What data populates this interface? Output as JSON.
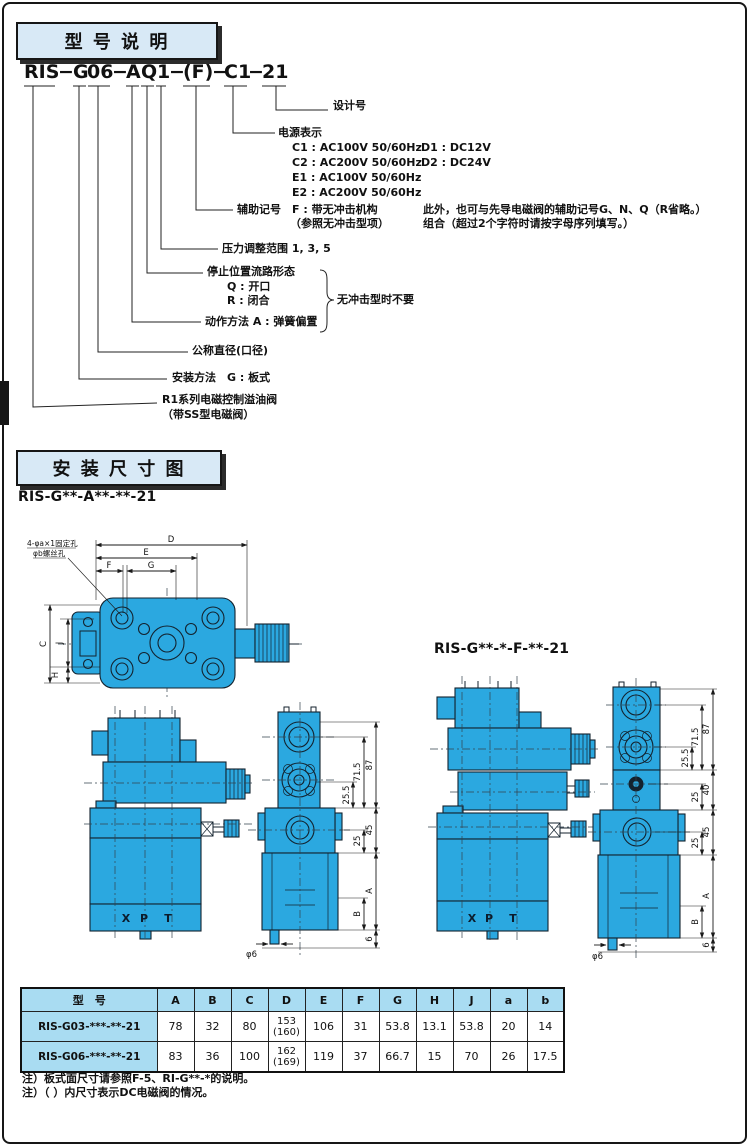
{
  "colors": {
    "cyan": "#2BA8E0",
    "panel": "#D8E9F6",
    "table_header": "#A9DCF2",
    "ink": "#111111"
  },
  "section1": {
    "title": "型 号 说 明",
    "code": [
      "RIS",
      "−",
      "G",
      "06",
      "−",
      "A",
      "Q",
      "1",
      "−",
      "(F)",
      "−",
      "C1",
      "−",
      "21"
    ],
    "callouts": {
      "design": "设计号",
      "power_title": "电源表示",
      "power_options": [
        {
          "left": "C1 : AC100V 50/60Hz",
          "right": "D1 : DC12V"
        },
        {
          "left": "C2 : AC200V 50/60Hz",
          "right": "D2 : DC24V"
        },
        {
          "left": "E1 : AC100V 50/60Hz",
          "right": ""
        },
        {
          "left": "E2 : AC200V 50/60Hz",
          "right": ""
        }
      ],
      "aux_line1": "辅助记号　F : 带无冲击机构",
      "aux_line2": "（参照无冲击型项）",
      "aux_note1": "此外，也可与先导电磁阀的辅助记号G、N、Q（R省略。）",
      "aux_note2": "组合（超过2个字符时请按字母序列填写。）",
      "pressure": "压力调整范围 1, 3, 5",
      "stop_title": "停止位置流路形态",
      "stop_q": "Q : 开口",
      "stop_r": "R : 闭合",
      "brace_note": "无冲击型时不要",
      "action": "动作方法 A : 弹簧偏置",
      "diameter": "公称直径(口径)",
      "mounting": "安装方法　G : 板式",
      "series1": "R1系列电磁控制溢油阀",
      "series2": "（带SS型电磁阀）"
    }
  },
  "section2": {
    "title": "安 装 尺 寸 图",
    "variant_a": "RIS-G**-A**-**-21",
    "variant_f": "RIS-G**-*-F-**-21",
    "hole_note1": "4-φa×1固定孔",
    "hole_note2": "φb螺丝孔",
    "dims": {
      "top": {
        "D": "D",
        "E": "E",
        "F": "F",
        "G": "G",
        "C": "C",
        "J": "J",
        "H": "H"
      },
      "front_a": {
        "h87": "87",
        "h715": "71.5",
        "h255": "25.5",
        "h45": "45",
        "h25": "25",
        "hA": "A",
        "hB": "B",
        "h6": "6",
        "phi": "φ6"
      },
      "front_f": {
        "h87": "87",
        "h715": "71.5",
        "h255": "25.5",
        "h40": "40",
        "h25a": "25",
        "h45": "45",
        "h25b": "25",
        "hA": "A",
        "hB": "B",
        "h6": "6",
        "phi": "φ6"
      },
      "ports": {
        "x": "X",
        "p": "P",
        "t": "T"
      }
    }
  },
  "table": {
    "headers": [
      "型　号",
      "A",
      "B",
      "C",
      "D",
      "E",
      "F",
      "G",
      "H",
      "J",
      "a",
      "b"
    ],
    "rows": [
      {
        "model": "RIS-G03-***-**-21",
        "A": "78",
        "B": "32",
        "C": "80",
        "D1": "153",
        "D2": "(160)",
        "E": "106",
        "F": "31",
        "G": "53.8",
        "H": "13.1",
        "J": "53.8",
        "a2": "20",
        "b2": "14"
      },
      {
        "model": "RIS-G06-***-**-21",
        "A": "83",
        "B": "36",
        "C": "100",
        "D1": "162",
        "D2": "(169)",
        "E": "119",
        "F": "37",
        "G": "66.7",
        "H": "15",
        "J": "70",
        "a2": "26",
        "b2": "17.5"
      }
    ]
  },
  "notes": [
    "注）板式面尺寸请参照F-5、RI-G**-*的说明。",
    "注）（ ）内尺寸表示DC电磁阀的情况。"
  ]
}
